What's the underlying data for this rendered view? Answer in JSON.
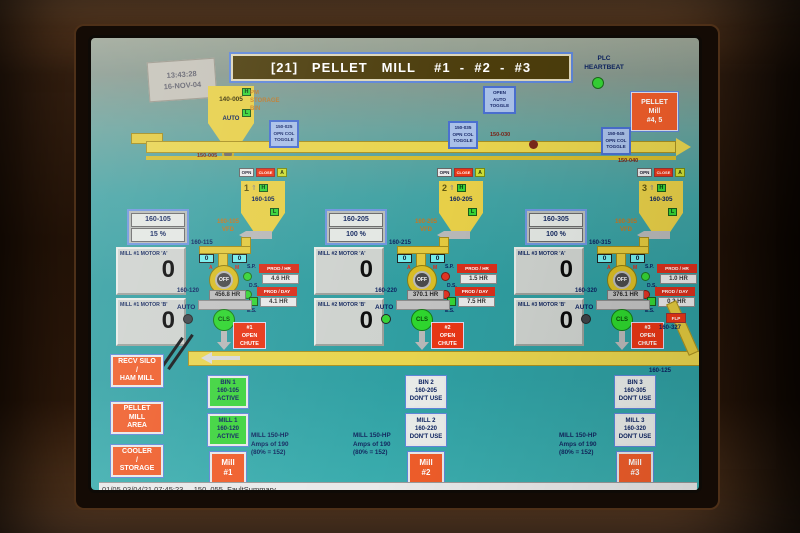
{
  "colors": {
    "green": "#35d435",
    "red_dot": "#e03424",
    "dark_dot": "#3f4448",
    "active_bg": "#3ed43e",
    "dont_use_bg": "#e9ece9",
    "alarm_red": "#e83616",
    "nav_orange": "#ef5d2a",
    "screen_teal": "#2f9fa2"
  },
  "header": {
    "title": "[21]   PELLET   MILL    #1  -  #2  -  #3",
    "stamp_line1": "13:43:28",
    "stamp_line2": "16-NOV-04",
    "plc_line1": "PLC",
    "plc_line2": "HEARTBEAT",
    "mill45_line1": "PELLET",
    "mill45_line2": "Mill",
    "mill45_line3": "#4, 5"
  },
  "source_bin": {
    "tag": "140-005",
    "high": "H",
    "low": "L",
    "mode": "AUTO",
    "note1": "PM",
    "note2": "STORAGE",
    "note3": "BIN"
  },
  "conveyor": {
    "label_left": "150-005",
    "label_mid": "150-030",
    "label_right": "150-040",
    "return_tag": "160-125"
  },
  "toggles": [
    {
      "l1": "150-025",
      "l2": "OPN COL",
      "l3": "TOGGLE"
    },
    {
      "l1": "OPEN",
      "l2": "AUTO",
      "l3": "TOGGLE"
    },
    {
      "l1": "150-035",
      "l2": "OPN COL",
      "l3": "TOGGLE"
    },
    {
      "l1": "150-045",
      "l2": "OPN COL",
      "l3": "TOGGLE"
    }
  ],
  "mills": [
    {
      "gate_opn": "OPN",
      "gate_close": "CLOSE",
      "gate_auto": "A",
      "hopper_no": "1",
      "hopper_arrow": "⇑",
      "high": "H",
      "low": "L",
      "hopper_tag": "160-105",
      "vfd_tag": "160-105",
      "vfd_pct": "15 %",
      "vfd_lbl1": "160-105",
      "vfd_lbl2": "VFD",
      "feeder_tag": "160-115",
      "motor_a_label": "MILL #1  MOTOR 'A'",
      "motor_a_value": "0",
      "motor_b_label": "MILL #1  MOTOR 'B'",
      "motor_b_value": "0",
      "spd_left": "0",
      "spd_right": "0",
      "dial_left": "A",
      "dial_right": "M",
      "dial_state": "OFF",
      "sp": "S.P.",
      "ds": "D.S.",
      "es": "E.S.",
      "sp_color": "#35d435",
      "ds_color": "#35d435",
      "prod1_label": "PROD / HR",
      "prod1_value": "4.6 HR",
      "prod2_label": "PROD / DAY",
      "prod2_value": "4.1 HR",
      "hours_tag": "160-120",
      "hours_value": "456.8 HR",
      "auto": "AUTO",
      "auto_color": "#3f4448",
      "cls": "CLS",
      "chute1": "#1",
      "chute2": "OPEN",
      "chute3": "CHUTE",
      "bin1": "BIN 1",
      "bin2": "160-105",
      "bin3": "ACTIVE",
      "bin_bg": "#3ed43e",
      "millst1": "MILL 1",
      "millst2": "160-120",
      "millst3": "ACTIVE",
      "millst_bg": "#3ed43e",
      "mbtn1": "Mill",
      "mbtn2": "#1",
      "hp1": "MILL 150-HP",
      "hp2": "Amps of 190",
      "hp3": "(80% = 152)"
    },
    {
      "gate_opn": "OPN",
      "gate_close": "CLOSE",
      "gate_auto": "A",
      "hopper_no": "2",
      "hopper_arrow": "⇑",
      "high": "H",
      "low": "L",
      "hopper_tag": "160-205",
      "vfd_tag": "160-205",
      "vfd_pct": "100 %",
      "vfd_lbl1": "160-205",
      "vfd_lbl2": "VFD",
      "feeder_tag": "160-215",
      "motor_a_label": "MILL #2  MOTOR 'A'",
      "motor_a_value": "0",
      "motor_b_label": "MILL #2  MOTOR 'B'",
      "motor_b_value": "0",
      "spd_left": "0",
      "spd_right": "0",
      "dial_left": "A",
      "dial_right": "M",
      "dial_state": "OFF",
      "sp": "S.P.",
      "ds": "D.S.",
      "es": "E.S.",
      "sp_color": "#e03424",
      "ds_color": "#e03424",
      "prod1_label": "PROD / HR",
      "prod1_value": "1.5 HR",
      "prod2_label": "PROD / DAY",
      "prod2_value": "7.5 HR",
      "hours_tag": "160-220",
      "hours_value": "370.1 HR",
      "auto": "AUTO",
      "auto_color": "#35d435",
      "cls": "CLS",
      "chute1": "#2",
      "chute2": "OPEN",
      "chute3": "CHUTE",
      "bin1": "BIN 2",
      "bin2": "160-205",
      "bin3": "DON'T USE",
      "bin_bg": "#e9ece9",
      "millst1": "MILL 2",
      "millst2": "160-220",
      "millst3": "DON'T USE",
      "millst_bg": "#e9ece9",
      "mbtn1": "Mill",
      "mbtn2": "#2",
      "hp1": "MILL 150-HP",
      "hp2": "Amps of 190",
      "hp3": "(80% = 152)"
    },
    {
      "gate_opn": "OPN",
      "gate_close": "CLOSE",
      "gate_auto": "A",
      "hopper_no": "3",
      "hopper_arrow": "⇑",
      "high": "H",
      "low": "L",
      "hopper_tag": "160-305",
      "vfd_tag": "160-305",
      "vfd_pct": "100 %",
      "vfd_lbl1": "160-305",
      "vfd_lbl2": "VFD",
      "feeder_tag": "160-315",
      "motor_a_label": "MILL #3  MOTOR 'A'",
      "motor_a_value": "0",
      "motor_b_label": "MILL #3  MOTOR 'B'",
      "motor_b_value": "0",
      "spd_left": "0",
      "spd_right": "0",
      "dial_left": "A",
      "dial_right": "M",
      "dial_state": "OFF",
      "sp": "S.P.",
      "ds": "D.S.",
      "es": "E.S.",
      "sp_color": "#35d435",
      "ds_color": "#e03424",
      "prod1_label": "PROD / HR",
      "prod1_value": "1.0 HR",
      "prod2_label": "PROD / DAY",
      "prod2_value": "0.2 HR",
      "hours_tag": "160-320",
      "hours_value": "376.1 HR",
      "auto": "AUTO",
      "auto_color": "#3f4448",
      "cls": "CLS",
      "chute1": "#3",
      "chute2": "OPEN",
      "chute3": "CHUTE",
      "bin1": "BIN 3",
      "bin2": "160-305",
      "bin3": "DON'T USE",
      "bin_bg": "#e9ece9",
      "millst1": "MILL 3",
      "millst2": "160-320",
      "millst3": "DON'T USE",
      "millst_bg": "#e9ece9",
      "mbtn1": "Mill",
      "mbtn2": "#3",
      "hp1": "MILL 150-HP",
      "hp2": "Amps of 190",
      "hp3": "(80% = 152)"
    }
  ],
  "mill3_extra": {
    "flap": "FLP",
    "tag": "160-327"
  },
  "nav": [
    {
      "l1": "RECV SILO",
      "l2": "/",
      "l3": "HAM MILL"
    },
    {
      "l1": "PELLET",
      "l2": "MILL",
      "l3": "AREA"
    },
    {
      "l1": "COOLER",
      "l2": "/",
      "l3": "STORAGE"
    }
  ],
  "footer": "01/05 03/04/21 07:45:23   _150_055_FaultSummary"
}
